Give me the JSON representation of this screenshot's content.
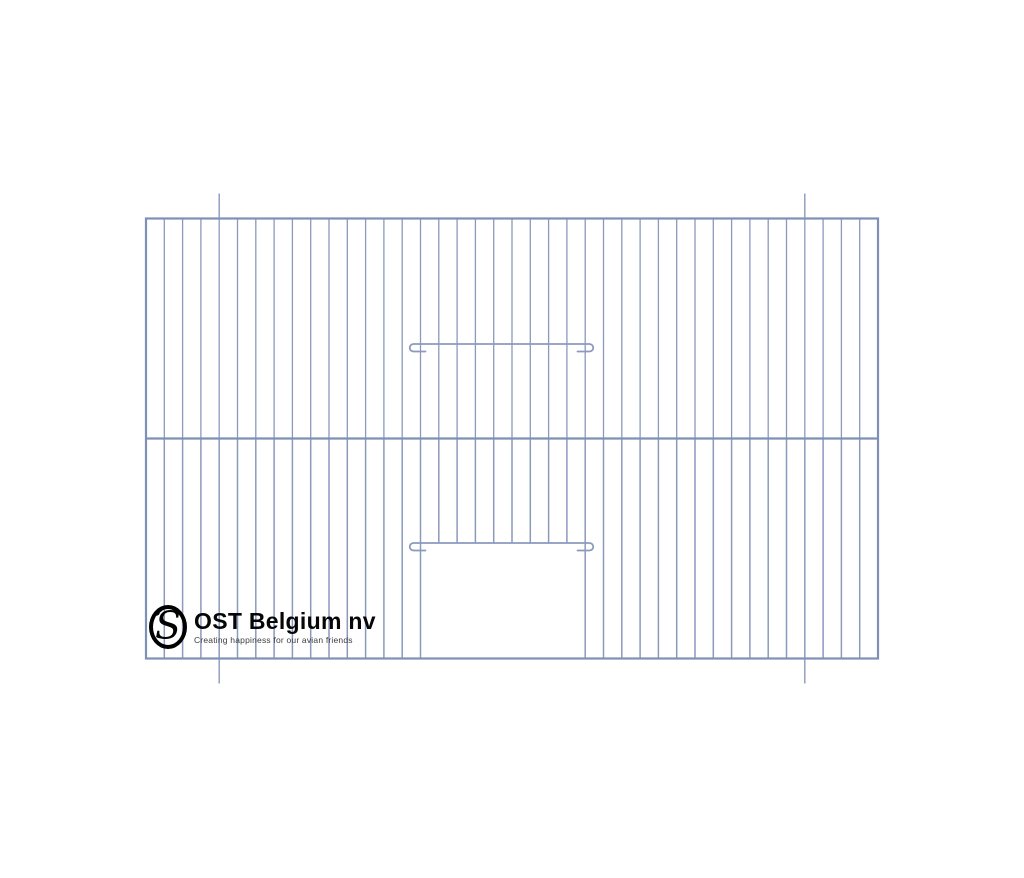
{
  "logo": {
    "monogram": "S",
    "name": "OST Belgium nv",
    "tagline": "Creating happiness for our avian friends"
  },
  "drawing": {
    "colors": {
      "wire": "#8b99bd",
      "frame": "#7f90b6"
    },
    "frame": {
      "x": 146,
      "y": 218.5,
      "width": 732,
      "height": 440
    },
    "mid_rail_y": 438.5,
    "wire_gaps": 40,
    "tick_marks": {
      "wire_indices": [
        4,
        36
      ],
      "length": 25
    },
    "latches": [
      {
        "y": 344,
        "x1": 413.5,
        "x2": 589.5,
        "hook_radius": 3.75,
        "stub": 12
      },
      {
        "y": 543,
        "x1": 413.5,
        "x2": 589.5,
        "hook_radius": 3.75,
        "stub": 12
      }
    ],
    "door_opening": {
      "left_wire_index": 15,
      "right_wire_index": 24,
      "top_y": 543
    }
  }
}
